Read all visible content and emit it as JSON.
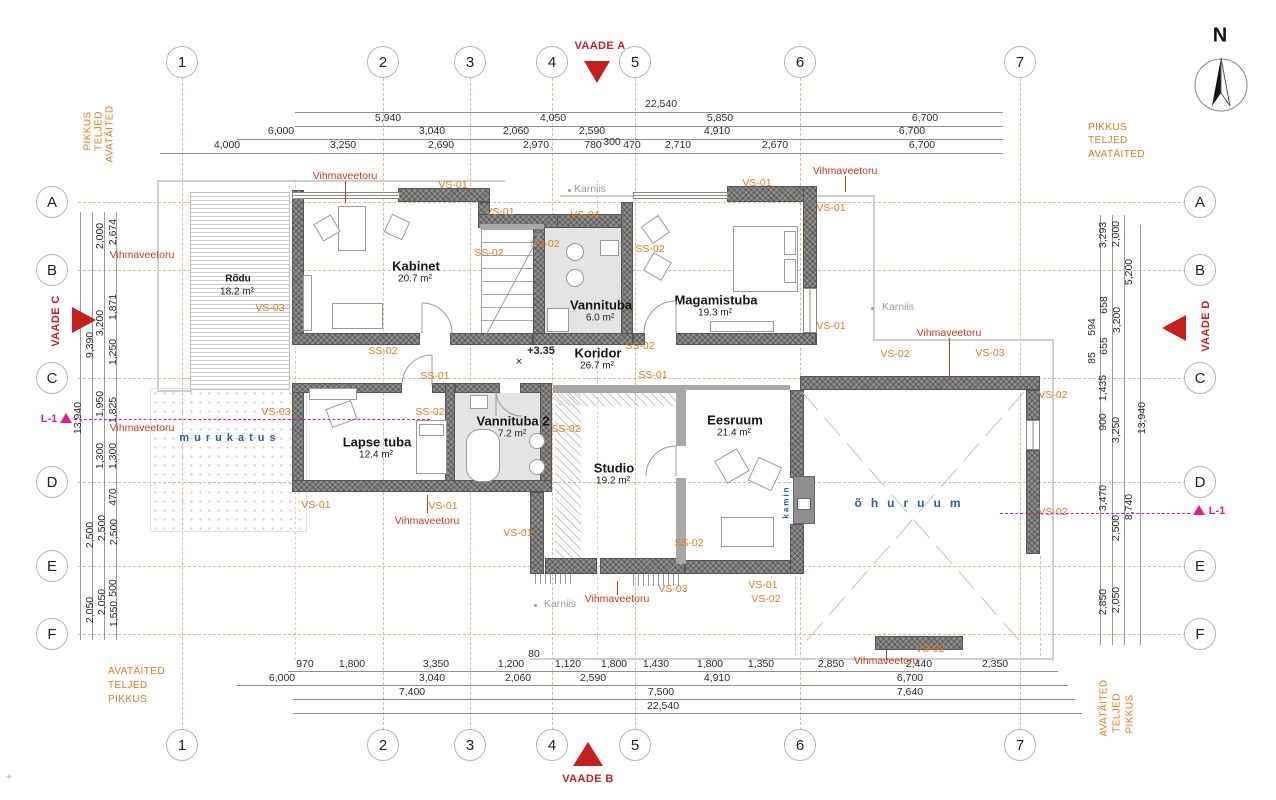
{
  "colors": {
    "accent_orange": "#e07b20",
    "label_red": "#c9391c",
    "view_red": "#c52020",
    "magenta": "#e6199a",
    "blue": "#2f5fa8",
    "gray_label": "#9b9b9b",
    "wall_gray": "#787878",
    "axis_dash": "#eeb28c"
  },
  "grid": {
    "columns": [
      {
        "label": "1",
        "x": 182
      },
      {
        "label": "2",
        "x": 383
      },
      {
        "label": "3",
        "x": 470
      },
      {
        "label": "4",
        "x": 552
      },
      {
        "label": "5",
        "x": 635
      },
      {
        "label": "6",
        "x": 800
      },
      {
        "label": "7",
        "x": 1020
      }
    ],
    "rows": [
      {
        "label": "A",
        "y": 202
      },
      {
        "label": "B",
        "y": 270
      },
      {
        "label": "C",
        "y": 378
      },
      {
        "label": "D",
        "y": 482
      },
      {
        "label": "E",
        "y": 566
      },
      {
        "label": "F",
        "y": 634
      }
    ],
    "top_y": 62,
    "bottom_y": 745,
    "left_x": 52,
    "right_x": 1200
  },
  "north": {
    "label": "N",
    "x": 1220,
    "y": 36
  },
  "views": [
    {
      "name": "VAADE A",
      "lx": 600,
      "ly": 46,
      "dir": "down",
      "tx": 597,
      "ty": 61
    },
    {
      "name": "VAADE B",
      "lx": 588,
      "ly": 779,
      "dir": "up",
      "tx": 588,
      "ty": 742
    },
    {
      "name": "VAADE C",
      "lx": 56,
      "ly": 321,
      "dir": "right",
      "tx": 72,
      "ty": 307
    },
    {
      "name": "VAADE D",
      "lx": 1206,
      "ly": 326,
      "dir": "left",
      "tx": 1162,
      "ty": 315
    }
  ],
  "levels": [
    {
      "label": "L-1",
      "lx": 49,
      "ly": 419,
      "tx": 66,
      "ty": 413,
      "line": {
        "x1": 74,
        "x2": 430,
        "y": 419
      }
    },
    {
      "label": "L-1",
      "lx": 1217,
      "ly": 511,
      "tx": 1199,
      "ty": 505,
      "line": {
        "x1": 1000,
        "x2": 1190,
        "y": 513
      }
    }
  ],
  "captions": [
    {
      "t": "PIKKUS",
      "x": 88,
      "y": 131,
      "v": 1
    },
    {
      "t": "TELJED",
      "x": 99,
      "y": 131,
      "v": 1
    },
    {
      "t": "AVATÄITED",
      "x": 110,
      "y": 134,
      "v": 1
    },
    {
      "t": "PIKKUS",
      "x": 1088,
      "y": 122,
      "v": 0
    },
    {
      "t": "TELJED",
      "x": 1088,
      "y": 135,
      "v": 0
    },
    {
      "t": "AVATÄITED",
      "x": 1088,
      "y": 149,
      "v": 0
    },
    {
      "t": "AVATÄITED",
      "x": 108,
      "y": 666,
      "v": 0
    },
    {
      "t": "TELJED",
      "x": 108,
      "y": 680,
      "v": 0
    },
    {
      "t": "PIKKUS",
      "x": 108,
      "y": 694,
      "v": 0
    },
    {
      "t": "AVATÄITED",
      "x": 1104,
      "y": 708,
      "v": 1
    },
    {
      "t": "TELJED",
      "x": 1117,
      "y": 713,
      "v": 1
    },
    {
      "t": "PIKKUS",
      "x": 1130,
      "y": 714,
      "v": 1
    }
  ],
  "dims": {
    "top_rows": [
      {
        "y": 104,
        "line_y": 112,
        "x1": 295,
        "x2": 1003,
        "items": [
          {
            "x": 661,
            "t": "22,540"
          }
        ]
      },
      {
        "y": 118,
        "line_y": 126,
        "x1": 295,
        "x2": 1003,
        "items": [
          {
            "x": 388,
            "t": "5,940"
          },
          {
            "x": 553,
            "t": "4,050"
          },
          {
            "x": 720,
            "t": "5,850"
          },
          {
            "x": 925,
            "t": "6,700"
          }
        ]
      },
      {
        "y": 131,
        "line_y": 139,
        "x1": 237,
        "x2": 1003,
        "items": [
          {
            "x": 281,
            "t": "6,000"
          },
          {
            "x": 432,
            "t": "3,040"
          },
          {
            "x": 516,
            "t": "2,060"
          },
          {
            "x": 592,
            "t": "2,590"
          },
          {
            "x": 717,
            "t": "4,910"
          },
          {
            "x": 912,
            "t": "6,700"
          }
        ]
      },
      {
        "y": 145,
        "line_y": 153,
        "x1": 160,
        "x2": 1003,
        "items": [
          {
            "x": 227,
            "t": "4,000"
          },
          {
            "x": 343,
            "t": "3,250"
          },
          {
            "x": 441,
            "t": "2,690"
          },
          {
            "x": 536,
            "t": "2,970"
          },
          {
            "x": 593,
            "t": "780"
          },
          {
            "x": 612,
            "t": "300",
            "dy": -3
          },
          {
            "x": 632,
            "t": "470"
          },
          {
            "x": 678,
            "t": "2,710"
          },
          {
            "x": 775,
            "t": "2,670"
          },
          {
            "x": 922,
            "t": "6,700"
          }
        ]
      }
    ],
    "bottom_rows": [
      {
        "y": 664,
        "line_y": 671,
        "x1": 288,
        "x2": 1058,
        "items": [
          {
            "x": 305,
            "t": "970"
          },
          {
            "x": 352,
            "t": "1,800"
          },
          {
            "x": 436,
            "t": "3,350"
          },
          {
            "x": 511,
            "t": "1,200"
          },
          {
            "x": 534,
            "t": "80",
            "dy": -10
          },
          {
            "x": 568,
            "t": "1,120"
          },
          {
            "x": 614,
            "t": "1,800"
          },
          {
            "x": 656,
            "t": "1,430"
          },
          {
            "x": 710,
            "t": "1,800"
          },
          {
            "x": 761,
            "t": "1,350"
          },
          {
            "x": 831,
            "t": "2,850"
          },
          {
            "x": 919,
            "t": "2,440"
          },
          {
            "x": 995,
            "t": "2,350"
          }
        ]
      },
      {
        "y": 678,
        "line_y": 685,
        "x1": 237,
        "x2": 1068,
        "items": [
          {
            "x": 282,
            "t": "6,000"
          },
          {
            "x": 432,
            "t": "3,040"
          },
          {
            "x": 518,
            "t": "2,060"
          },
          {
            "x": 593,
            "t": "2,590"
          },
          {
            "x": 717,
            "t": "4,910"
          },
          {
            "x": 910,
            "t": "6,700"
          }
        ]
      },
      {
        "y": 692,
        "line_y": 699,
        "x1": 293,
        "x2": 1075,
        "items": [
          {
            "x": 412,
            "t": "7,400"
          },
          {
            "x": 661,
            "t": "7,500"
          },
          {
            "x": 910,
            "t": "7,640"
          }
        ]
      },
      {
        "y": 706,
        "line_y": 713,
        "x1": 293,
        "x2": 1082,
        "items": [
          {
            "x": 663,
            "t": "22,540"
          }
        ]
      }
    ],
    "left": [
      {
        "x": 113,
        "y": 232,
        "t": "2,674"
      },
      {
        "x": 100,
        "y": 236,
        "t": "2,000"
      },
      {
        "x": 113,
        "y": 307,
        "t": "1,871"
      },
      {
        "x": 100,
        "y": 323,
        "t": "3,200"
      },
      {
        "x": 90,
        "y": 345,
        "t": "9,390"
      },
      {
        "x": 113,
        "y": 352,
        "t": "1,250"
      },
      {
        "x": 78,
        "y": 418,
        "t": "13,940"
      },
      {
        "x": 100,
        "y": 404,
        "t": "1,950"
      },
      {
        "x": 113,
        "y": 410,
        "t": "1,825"
      },
      {
        "x": 100,
        "y": 456,
        "t": "1,300"
      },
      {
        "x": 113,
        "y": 456,
        "t": "1,300"
      },
      {
        "x": 113,
        "y": 497,
        "t": "470"
      },
      {
        "x": 90,
        "y": 535,
        "t": "2,500"
      },
      {
        "x": 102,
        "y": 528,
        "t": "2,500"
      },
      {
        "x": 114,
        "y": 532,
        "t": "2,500"
      },
      {
        "x": 113,
        "y": 588,
        "t": "500"
      },
      {
        "x": 90,
        "y": 610,
        "t": "2,050"
      },
      {
        "x": 102,
        "y": 602,
        "t": "2,050"
      },
      {
        "x": 114,
        "y": 614,
        "t": "1,550"
      }
    ],
    "right": [
      {
        "x": 1103,
        "y": 235,
        "t": "3,293"
      },
      {
        "x": 1116,
        "y": 234,
        "t": "2,000"
      },
      {
        "x": 1129,
        "y": 272,
        "t": "5,200"
      },
      {
        "x": 1104,
        "y": 305,
        "t": "658"
      },
      {
        "x": 1092,
        "y": 327,
        "t": "594"
      },
      {
        "x": 1117,
        "y": 320,
        "t": "3,200"
      },
      {
        "x": 1104,
        "y": 346,
        "t": "655"
      },
      {
        "x": 1092,
        "y": 358,
        "t": "85"
      },
      {
        "x": 1103,
        "y": 388,
        "t": "1,435"
      },
      {
        "x": 1103,
        "y": 422,
        "t": "900"
      },
      {
        "x": 1116,
        "y": 430,
        "t": "3,250"
      },
      {
        "x": 1142,
        "y": 418,
        "t": "13,940"
      },
      {
        "x": 1103,
        "y": 498,
        "t": "3,470"
      },
      {
        "x": 1116,
        "y": 528,
        "t": "2,500"
      },
      {
        "x": 1129,
        "y": 507,
        "t": "8,740"
      },
      {
        "x": 1103,
        "y": 602,
        "t": "2,850"
      },
      {
        "x": 1116,
        "y": 600,
        "t": "2,050"
      }
    ]
  },
  "rooms": [
    {
      "name": "Rõdu",
      "area": "18.2 m²",
      "x": 238,
      "y": 279,
      "small": true
    },
    {
      "name": "Kabinet",
      "area": "20.7 m²",
      "x": 416,
      "y": 266
    },
    {
      "name": "Vannituba",
      "area": "6.0 m²",
      "x": 601,
      "y": 305
    },
    {
      "name": "Magamistuba",
      "area": "19.3 m²",
      "x": 716,
      "y": 300
    },
    {
      "name": "Koridor",
      "area": "26.7 m²",
      "x": 598,
      "y": 353
    },
    {
      "name": "Lapse tuba",
      "area": "12.4 m²",
      "x": 377,
      "y": 442
    },
    {
      "name": "Vannituba 2",
      "area": "7.2 m²",
      "x": 513,
      "y": 421
    },
    {
      "name": "Studio",
      "area": "19.2 m²",
      "x": 614,
      "y": 468
    },
    {
      "name": "Eesruum",
      "area": "21.4 m²",
      "x": 735,
      "y": 420
    }
  ],
  "annotations": [
    {
      "t": "VS-01",
      "x": 453,
      "y": 185,
      "c": "o"
    },
    {
      "t": "VS-01",
      "x": 500,
      "y": 212,
      "c": "o"
    },
    {
      "t": "SS-02",
      "x": 489,
      "y": 253,
      "c": "o"
    },
    {
      "t": "SS-02",
      "x": 545,
      "y": 244,
      "c": "o"
    },
    {
      "t": "VS-04",
      "x": 585,
      "y": 215,
      "c": "o"
    },
    {
      "t": "SS-02",
      "x": 650,
      "y": 249,
      "c": "o"
    },
    {
      "t": "VS-01",
      "x": 757,
      "y": 183,
      "c": "o"
    },
    {
      "t": "VS-01",
      "x": 831,
      "y": 208,
      "c": "o"
    },
    {
      "t": "VS-01",
      "x": 831,
      "y": 326,
      "c": "o"
    },
    {
      "t": "SS-02",
      "x": 640,
      "y": 346,
      "c": "o"
    },
    {
      "t": "SS-01",
      "x": 653,
      "y": 375,
      "c": "o"
    },
    {
      "t": "SS-01",
      "x": 435,
      "y": 376,
      "c": "o"
    },
    {
      "t": "SS-02",
      "x": 383,
      "y": 351,
      "c": "o"
    },
    {
      "t": "SS-02",
      "x": 430,
      "y": 412,
      "c": "o"
    },
    {
      "t": "SS-02",
      "x": 566,
      "y": 429,
      "c": "o"
    },
    {
      "t": "SS-02",
      "x": 689,
      "y": 543,
      "c": "o"
    },
    {
      "t": "VS-03",
      "x": 270,
      "y": 308,
      "c": "o"
    },
    {
      "t": "VS-03",
      "x": 276,
      "y": 412,
      "c": "o"
    },
    {
      "t": "VS-01",
      "x": 316,
      "y": 505,
      "c": "o"
    },
    {
      "t": "VS-01",
      "x": 443,
      "y": 506,
      "c": "o"
    },
    {
      "t": "VS-01",
      "x": 518,
      "y": 533,
      "c": "o"
    },
    {
      "t": "VS-03",
      "x": 673,
      "y": 589,
      "c": "o"
    },
    {
      "t": "VS-01",
      "x": 763,
      "y": 585,
      "c": "o"
    },
    {
      "t": "VS-02",
      "x": 766,
      "y": 599,
      "c": "o"
    },
    {
      "t": "VS-02",
      "x": 895,
      "y": 354,
      "c": "o"
    },
    {
      "t": "VS-03",
      "x": 990,
      "y": 353,
      "c": "o"
    },
    {
      "t": "VS-02",
      "x": 1053,
      "y": 395,
      "c": "o"
    },
    {
      "t": "VS-02",
      "x": 1053,
      "y": 512,
      "c": "o"
    },
    {
      "t": "VS-02",
      "x": 930,
      "y": 649,
      "c": "o"
    },
    {
      "t": "Vihmaveetoru",
      "x": 345,
      "y": 176,
      "c": "r"
    },
    {
      "t": "Vihmaveetoru",
      "x": 845,
      "y": 171,
      "c": "r"
    },
    {
      "t": "Vihmaveetoru",
      "x": 949,
      "y": 333,
      "c": "r"
    },
    {
      "t": "Vihmaveetoru",
      "x": 142,
      "y": 255,
      "c": "r"
    },
    {
      "t": "Vihmaveetoru",
      "x": 142,
      "y": 428,
      "c": "r"
    },
    {
      "t": "Vihmaveetoru",
      "x": 427,
      "y": 521,
      "c": "r"
    },
    {
      "t": "Vihmaveetoru",
      "x": 617,
      "y": 599,
      "c": "r"
    },
    {
      "t": "Vihmaveetoru",
      "x": 886,
      "y": 661,
      "c": "r"
    },
    {
      "t": "Karniis",
      "x": 590,
      "y": 189,
      "c": "g"
    },
    {
      "t": "Karniis",
      "x": 898,
      "y": 307,
      "c": "g"
    },
    {
      "t": "Karniis",
      "x": 560,
      "y": 604,
      "c": "g"
    }
  ],
  "blue_texts": [
    {
      "t": "murukatus",
      "x": 230,
      "y": 438,
      "ls": 5,
      "size": 11,
      "v": 0
    },
    {
      "t": "õhuruum",
      "x": 912,
      "y": 503,
      "ls": 9,
      "size": 12,
      "v": 0
    },
    {
      "t": "kamin",
      "x": 786,
      "y": 502,
      "ls": 2,
      "size": 8,
      "v": 1
    }
  ],
  "level_mark": {
    "t": "+3.35",
    "x": 541,
    "y": 351,
    "sym_x": 519,
    "sym_y": 362
  },
  "corner_mark": {
    "t": "+",
    "x": 6,
    "y": 772
  }
}
